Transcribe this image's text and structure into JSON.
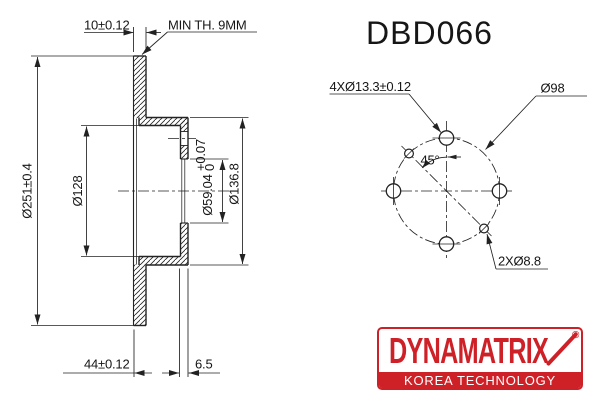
{
  "title": "DBD066",
  "section_view": {
    "dim_pad_thickness": "10±0.12",
    "min_thickness_note": "MIN TH. 9MM",
    "dim_outer_diameter": "Ø251±0.4",
    "dim_hat_inner_diameter": "Ø128",
    "dim_center_bore": {
      "value": "Ø59.04",
      "tol_upper": "+0.07",
      "tol_lower": "0"
    },
    "dim_hat_outer_diameter": "Ø136.8",
    "dim_overall_height": "44±0.12",
    "dim_mounting_thickness": "6.5"
  },
  "front_view": {
    "dim_bolt_holes": "4XØ13.3±0.12",
    "dim_bolt_circle": "Ø98",
    "angle_between_holes": "45°",
    "dim_locating_holes": "2XØ8.8"
  },
  "logo": {
    "brand": "DYNAMATRIX",
    "registered_mark": "®",
    "tagline": "KOREA TECHNOLOGY",
    "brand_color": "#ce2027"
  },
  "colors": {
    "line": "#222222",
    "background": "#ffffff"
  }
}
